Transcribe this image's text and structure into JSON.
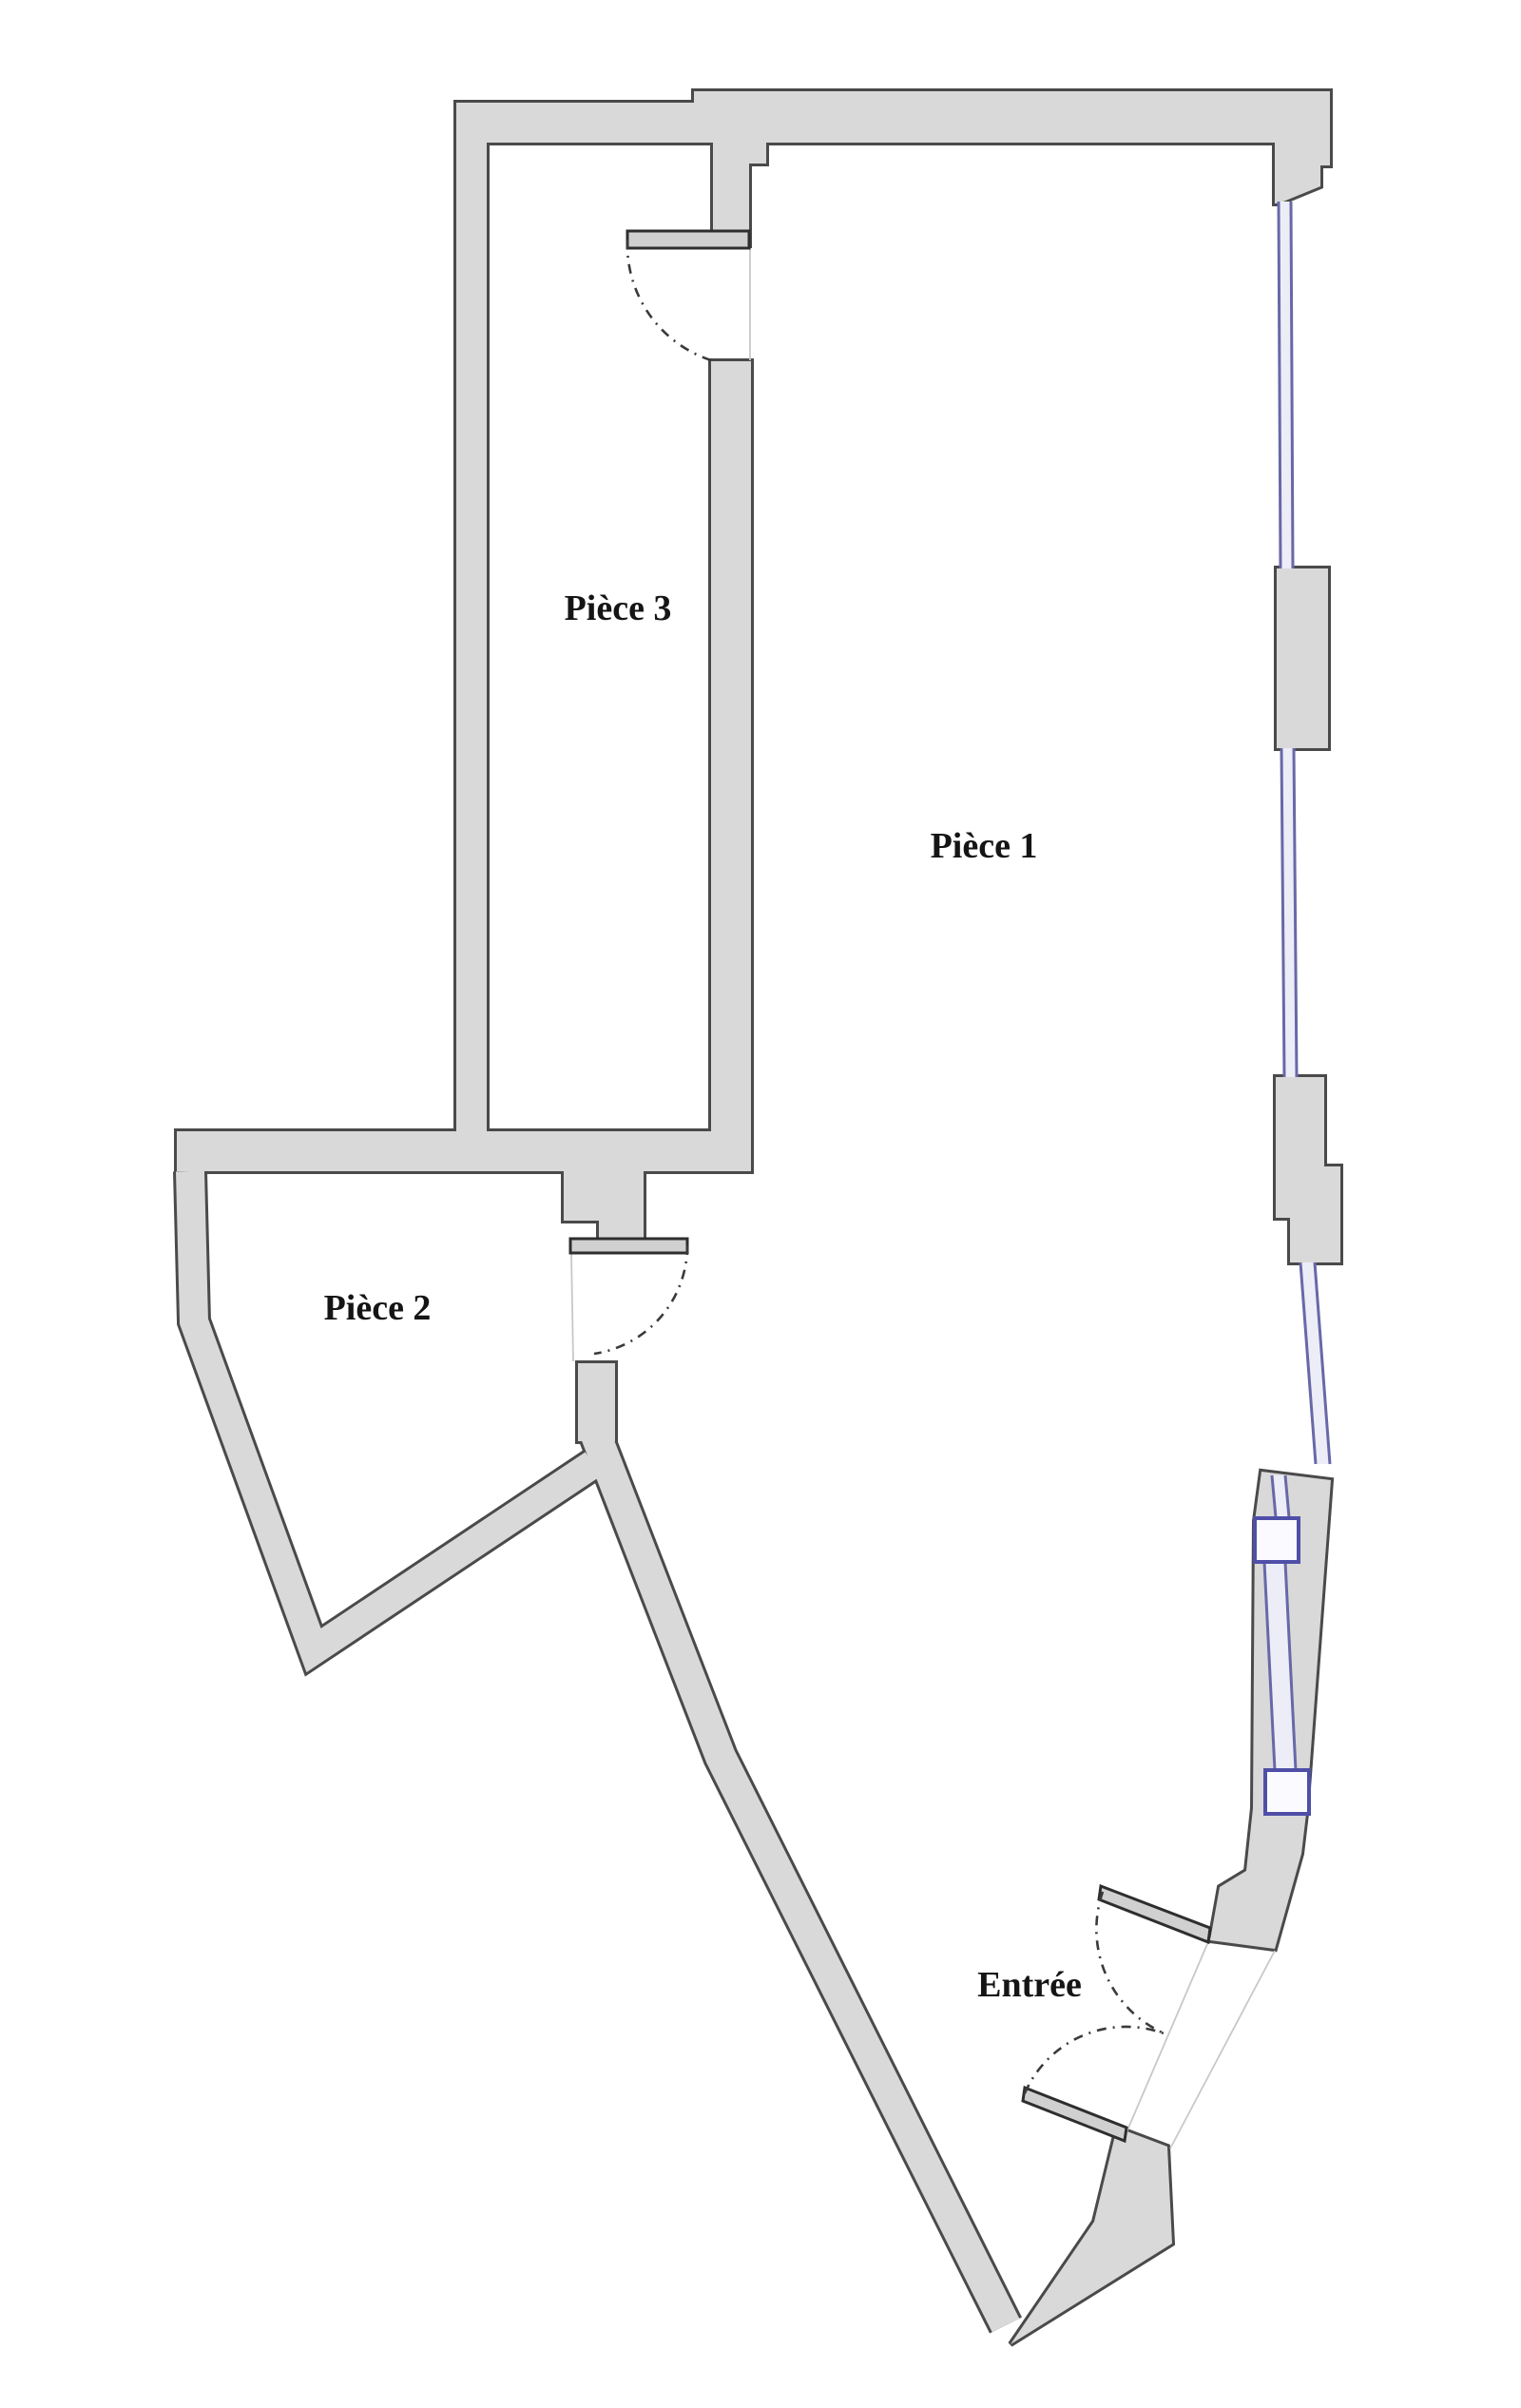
{
  "floor_plan": {
    "rooms": [
      {
        "id": "piece-3",
        "label": "Pièce 3"
      },
      {
        "id": "piece-1",
        "label": "Pièce 1"
      },
      {
        "id": "piece-2",
        "label": "Pièce 2"
      },
      {
        "id": "entree",
        "label": "Entrée"
      }
    ],
    "doors": [
      "piece-3-door",
      "piece-2-door",
      "entree-door-upper",
      "entree-door-lower"
    ],
    "windows": [
      "window-right-upper",
      "window-right-middle",
      "window-right-lower",
      "french-window"
    ],
    "colors": {
      "background": "#ffffff",
      "wall_fill": "#d9d9d9",
      "wall_outline": "#4a4a4a",
      "window_blue": "#6868a8",
      "window_frame": "#4f4fa8",
      "window_fill": "#ededf8",
      "door_leaf_fill": "#d0d0d0",
      "door_leaf_edge": "#2e2e2e",
      "door_arc": "#3a3a3a",
      "faint_line": "#c8c8c8",
      "label_text": "#151515"
    }
  }
}
